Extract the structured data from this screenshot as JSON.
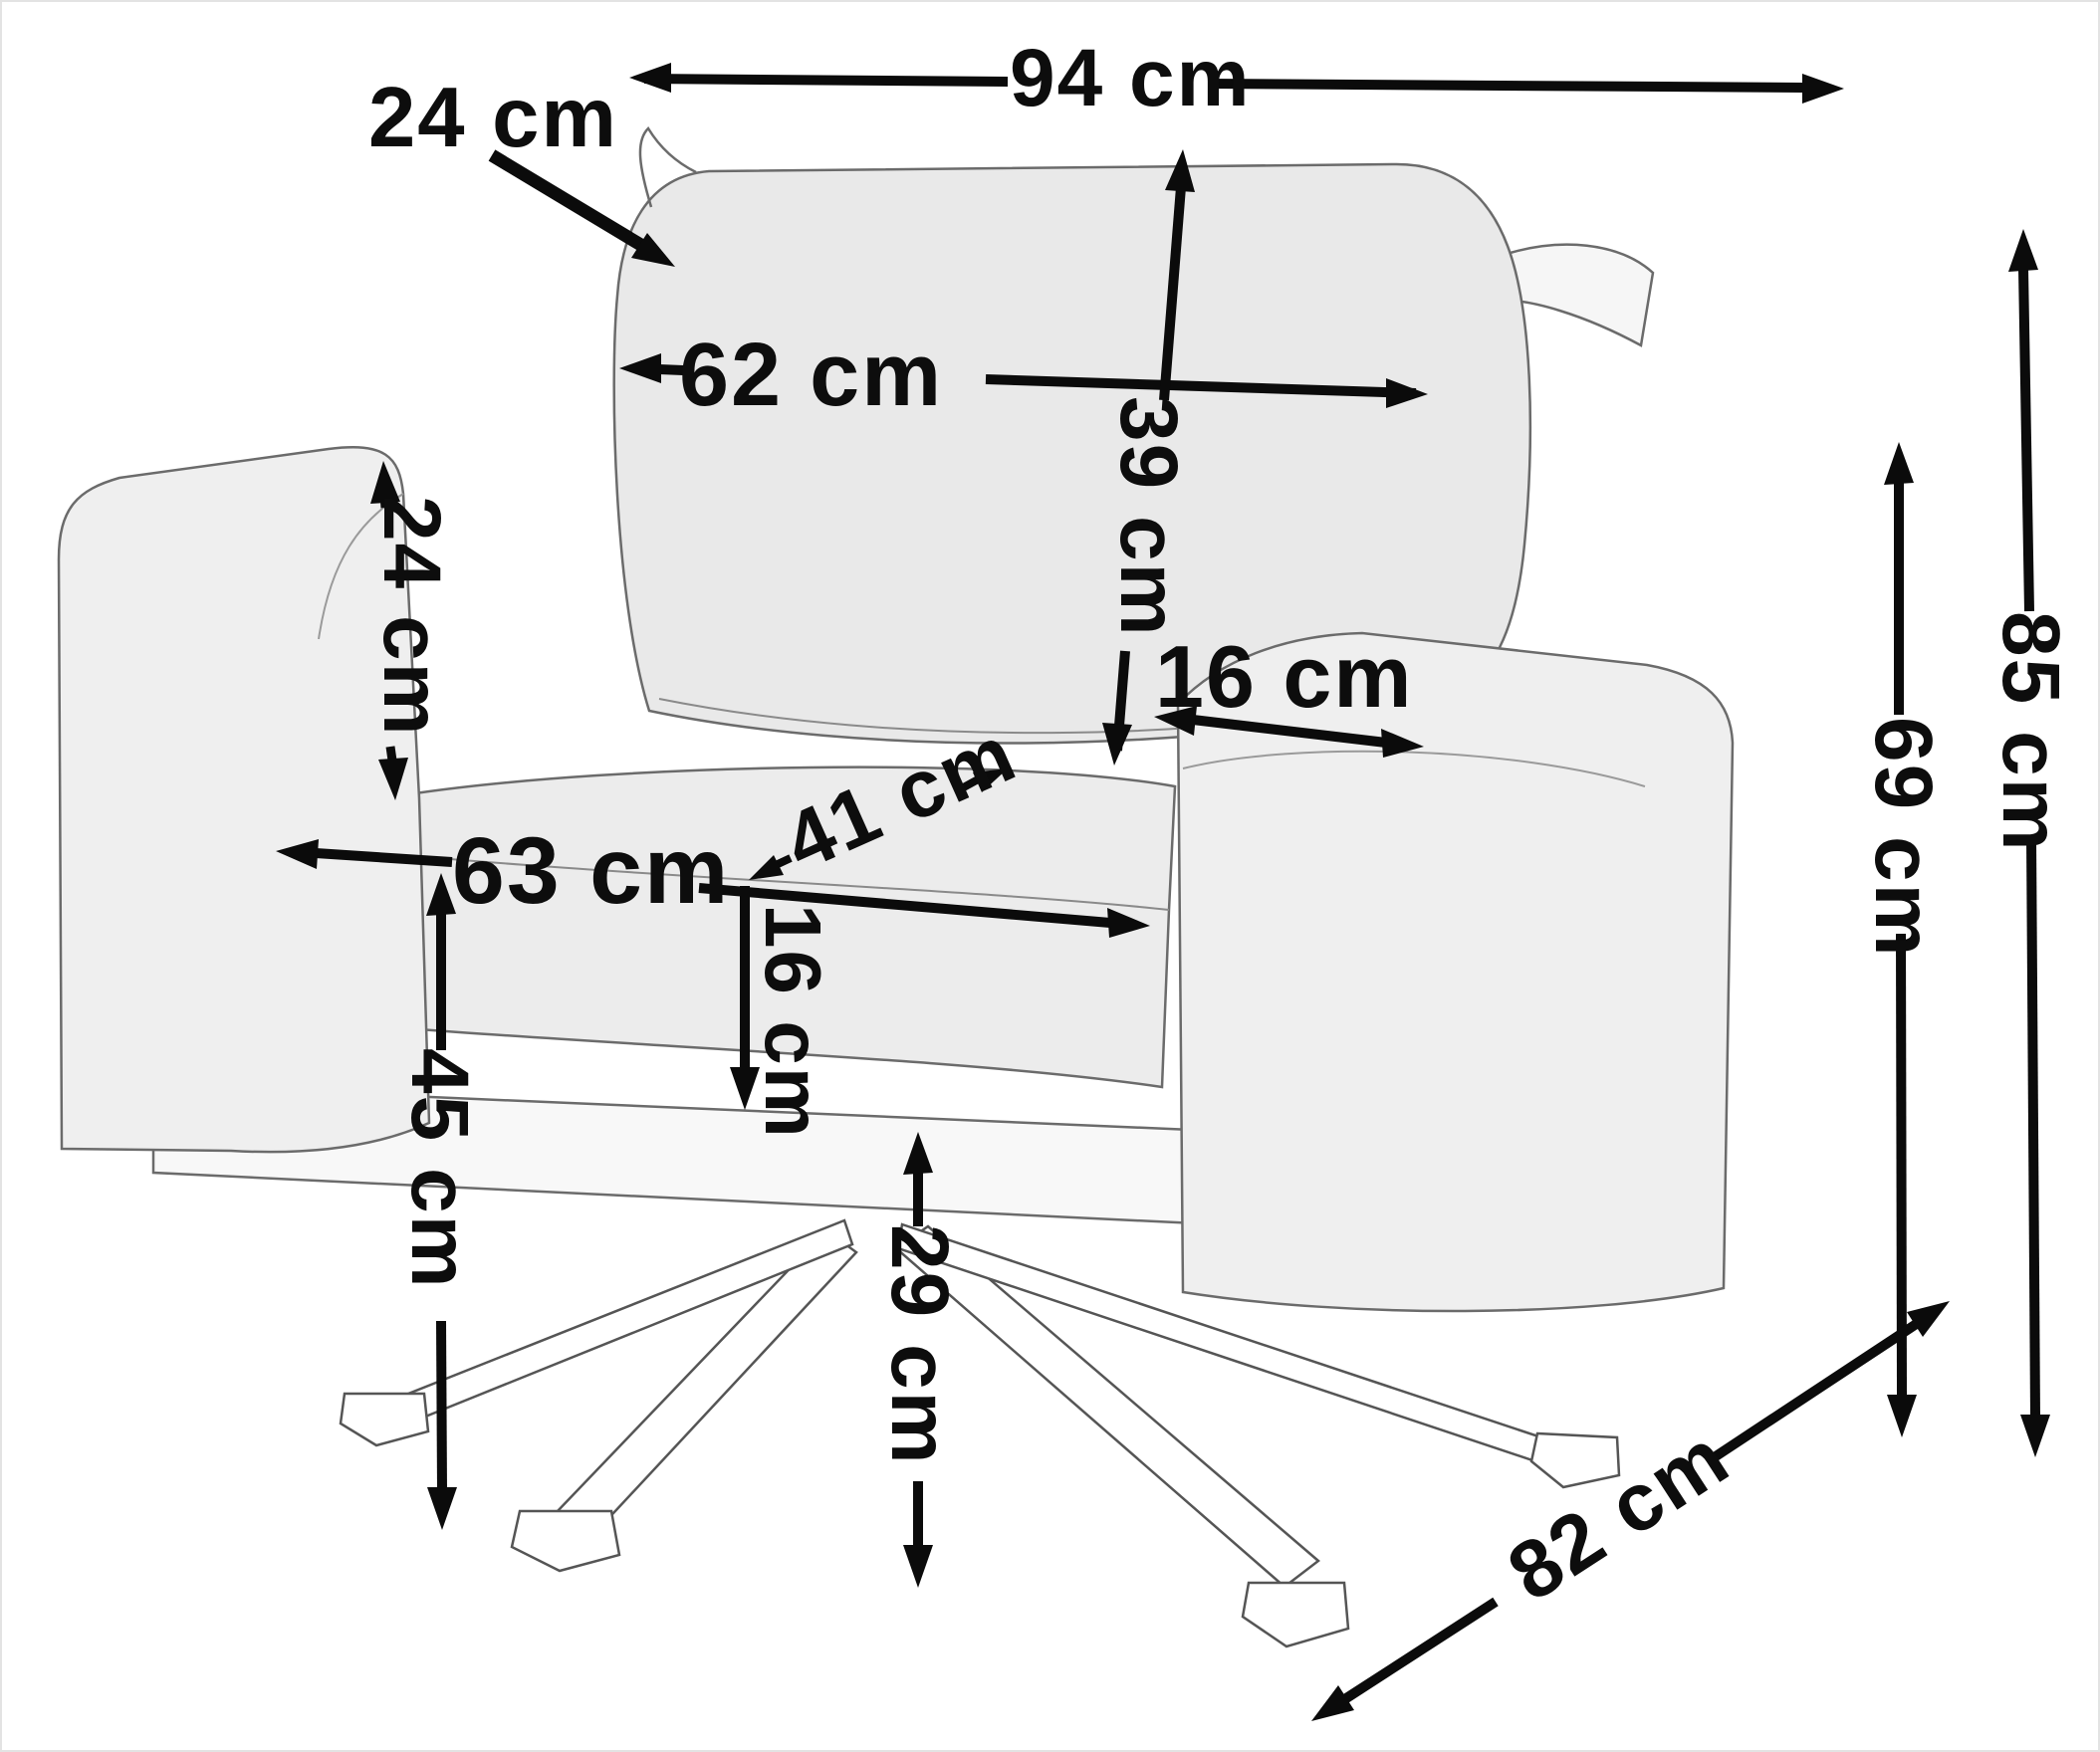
{
  "diagram": {
    "type": "product-dimension-diagram",
    "subject": "upholstered armchair with crossed metal star legs",
    "unit": "cm",
    "background_color": "#ffffff",
    "dimension_line_color": "#0b0b0b",
    "sketch_line_color": "#6b6b6b"
  },
  "dimensions": {
    "overall_width": {
      "label": "94 cm",
      "value": 94,
      "unit": "cm",
      "measures": "overall width across the back"
    },
    "back_cushion_depth": {
      "label": "24 cm",
      "value": 24,
      "unit": "cm",
      "measures": "back cushion thickness"
    },
    "back_cushion_width": {
      "label": "62 cm",
      "value": 62,
      "unit": "cm",
      "measures": "back cushion width"
    },
    "back_cushion_height": {
      "label": "39 cm",
      "value": 39,
      "unit": "cm",
      "measures": "back cushion height"
    },
    "armrest_width": {
      "label": "16 cm",
      "value": 16,
      "unit": "cm",
      "measures": "armrest width"
    },
    "seat_depth": {
      "label": "41 cm",
      "value": 41,
      "unit": "cm",
      "measures": "seat depth"
    },
    "armrest_above_seat": {
      "label": "24 cm",
      "value": 24,
      "unit": "cm",
      "measures": "armrest height above seat"
    },
    "seat_width": {
      "label": "63 cm",
      "value": 63,
      "unit": "cm",
      "measures": "seat width between arms"
    },
    "seat_cushion_height": {
      "label": "16 cm",
      "value": 16,
      "unit": "cm",
      "measures": "seat cushion thickness"
    },
    "seat_height": {
      "label": "45 cm",
      "value": 45,
      "unit": "cm",
      "measures": "seat height from floor"
    },
    "underseat_clearance": {
      "label": "29 cm",
      "value": 29,
      "unit": "cm",
      "measures": "clearance under seat frame"
    },
    "armrest_height": {
      "label": "69 cm",
      "value": 69,
      "unit": "cm",
      "measures": "armrest height from floor"
    },
    "overall_height": {
      "label": "85 cm",
      "value": 85,
      "unit": "cm",
      "measures": "overall height"
    },
    "overall_depth": {
      "label": "82 cm",
      "value": 82,
      "unit": "cm",
      "measures": "overall depth"
    }
  }
}
